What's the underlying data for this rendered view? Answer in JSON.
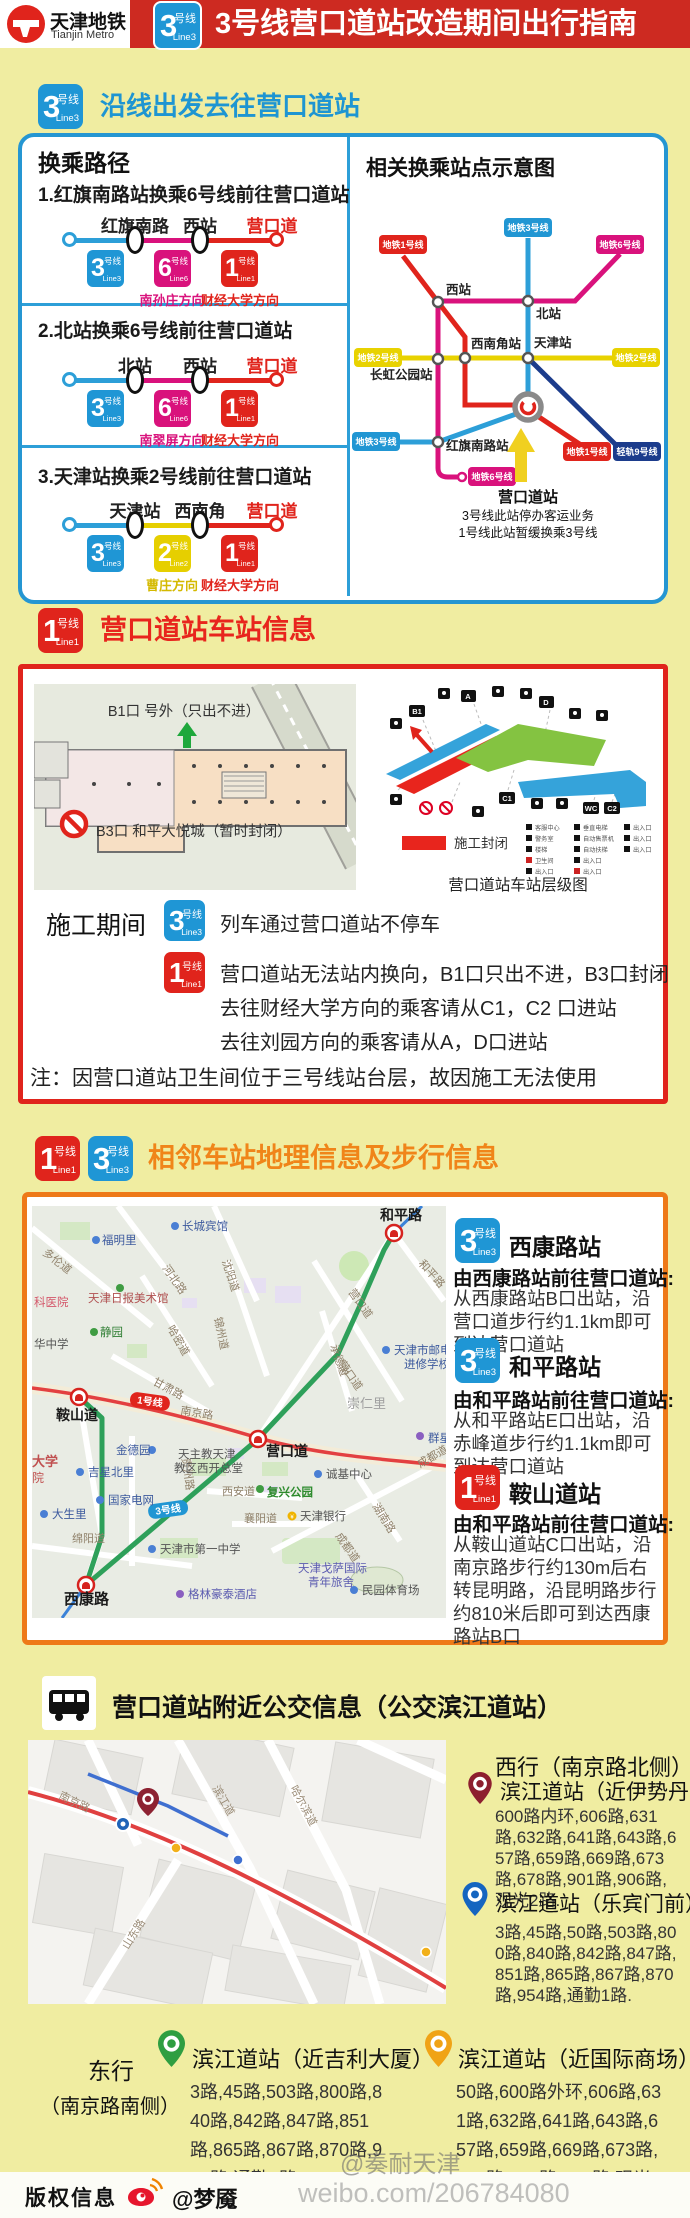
{
  "lines": {
    "l1": {
      "num": "1",
      "cn": "号线",
      "en": "Line1"
    },
    "l2": {
      "num": "2",
      "cn": "号线",
      "en": "Line2"
    },
    "l3": {
      "num": "3",
      "cn": "号线",
      "en": "Line3"
    },
    "l6": {
      "num": "6",
      "cn": "号线",
      "en": "Line6"
    }
  },
  "header": {
    "logo_cn": "天津地铁",
    "logo_en": "Tianjin Metro",
    "title": "3号线营口道站改造期间出行指南"
  },
  "s1": {
    "heading": "沿线出发去往营口道站",
    "left_title": "换乘路径",
    "routes": [
      {
        "no": "1.红旗南路站换乘6号线前往营口道站",
        "st1": "红旗南路",
        "st2": "西站",
        "st3": "营口道",
        "dir1": "南孙庄方向",
        "dir2": "财经大学方向"
      },
      {
        "no": "2.北站换乘6号线前往营口道站",
        "st1": "北站",
        "st2": "西站",
        "st3": "营口道",
        "dir1": "南翠屏方向",
        "dir2": "财经大学方向"
      },
      {
        "no": "3.天津站换乘2号线前往营口道站",
        "st1": "天津站",
        "st2": "西南角",
        "st3": "营口道",
        "dir1": "曹庄方向",
        "dir2": "财经大学方向"
      }
    ],
    "right_title": "相关换乘站点示意图",
    "sch": {
      "b_l1": "地铁1号线",
      "b_l2": "地铁2号线",
      "b_l3": "地铁3号线",
      "b_l6": "地铁6号线",
      "b_l9": "轻轨9号线",
      "xizhan": "西站",
      "beizhan": "北站",
      "xinanjiao": "西南角站",
      "tianjinzhan": "天津站",
      "changhong": "长虹公园站",
      "hongqi": "红旗南路站",
      "callout1": "营口道站",
      "callout2": "3号线此站停办客运业务",
      "callout3": "1号线此站暂缓换乘3号线"
    }
  },
  "s2": {
    "title": "营口道站车站信息",
    "plan": {
      "b1": "B1口 号外（只出不进）",
      "b3": "B3口 和平大悦城（暂时封闭）"
    },
    "level": {
      "legend": "施工封闭",
      "caption": "营口道站车站层级图",
      "e_b1": "B1",
      "e_a": "A",
      "e_d": "D",
      "e_c1": "C1",
      "e_c2": "C2",
      "e_wc": "WC",
      "mini": [
        "客服中心",
        "警务室",
        "楼梯",
        "卫生间",
        "出入口",
        "垂直电梯",
        "自动售票机",
        "自动扶梯",
        "出入口",
        "出入口",
        "出入口",
        "出入口",
        "出入口"
      ]
    },
    "cons": {
      "label": "施工期间",
      "l3_text": "列车通过营口道站不停车",
      "l1_text1": "营口道站无法站内换向，B1口只出不进，B3口封闭",
      "l1_text2": "去往财经大学方向的乘客请从C1，C2 口进站",
      "l1_text3": "去往刘园方向的乘客请从A，D口进站",
      "note": "注：因营口道站卫生间位于三号线站台层，故因施工无法使用"
    }
  },
  "s3": {
    "title": "相邻车站地理信息及步行信息",
    "cards": [
      {
        "name": "西康路站",
        "bold": "由西康路站前往营口道站:",
        "text": "从西康路站B口出站，沿营口道步行约1.1km即可到达营口道站"
      },
      {
        "name": "和平路站",
        "bold": "由和平路站前往营口道站:",
        "text": "从和平路站E口出站，沿赤峰道步行约1.1km即可到达营口道站"
      },
      {
        "name": "鞍山道站",
        "bold": "由和平路站前往营口道站:",
        "text": "从鞍山道站C口出站，沿南京路步行约130m后右转昆明路，沿昆明路步行约810米后即可到达西康路站B口"
      }
    ],
    "map": {
      "duolun": "多伦道",
      "fumingli": "福明里",
      "changcheng": "长城宾馆",
      "hebeilu": "河北路",
      "shenyang": "沈阳道",
      "meishuguan": "天津日报美术馆",
      "jingyuan": "静园",
      "keyi": "科医院",
      "huazhong": "华中学",
      "hami": "哈密道",
      "jinzhou": "锦州道",
      "gansu": "甘肃路",
      "anshandao": "鞍山道",
      "badge_l1": "1号线",
      "nanjinglu": "南京路",
      "chongrenli": "崇仁里",
      "chengde": "承德道",
      "yingkoudao": "营口道",
      "hepinglu": "和平路",
      "youdian1": "天津市邮电通",
      "youdian2": "进修学校",
      "qunxing": "群星",
      "jindeyuan": "金德园",
      "jixing": "吉星北里",
      "dianwang": "国家电网",
      "dashengli": "大生里",
      "mianyang": "绵阳道",
      "tianzhujiao1": "天主教天津",
      "tianzhujiao2": "教区西开总堂",
      "xian": "西安道",
      "fuxing": "复兴公园",
      "xiangyang": "襄阳道",
      "yinhang": "天津银行",
      "chengji": "诚基中心",
      "chengdu": "成都道",
      "hunan": "湖南路",
      "yizhong": "天津市第一中学",
      "gesa1": "天津戈萨国际",
      "gesa2": "青年旅舍",
      "gelin": "格林豪泰酒店",
      "minyuan": "民园体育场",
      "xikanglu": "西康路",
      "badge_l3": "3号线",
      "daxue": "大学",
      "yuan": "院",
      "guizhou": "贵州路"
    }
  },
  "s4": {
    "title": "营口道站附近公交信息（公交滨江道站）",
    "west_heading": "西行（南京路北侧）",
    "west": [
      {
        "name": "滨江道站（近伊势丹）",
        "routes": "600路内环,606路,631路,632路,641路,643路,657路,659路,669路,673路,678路,901路,906路,观光2路."
      },
      {
        "name": "滨江道站（乐宾门前）",
        "routes": "3路,45路,50路,503路,800路,840路,842路,847路,851路,865路,867路,870路,954路,通勤1路."
      }
    ],
    "east_heading1": "东行",
    "east_heading2": "（南京路南侧）",
    "east": [
      {
        "name": "滨江道站（近吉利大厦）",
        "routes": "3路,45路,503路,800路,840路,842路,847路,851路,865路,867路,870路,954路,通勤1路."
      },
      {
        "name": "滨江道站（近国际商场）",
        "routes": "50路,600路外环,606路,631路,632路,641路,643路,657路,659路,669路,673路,678路,901路,906路,观光2路"
      }
    ],
    "map": {
      "nanjinglu": "南京路",
      "haerbin": "哈尔滨道",
      "binjiang": "滨江道",
      "shandong": "山东路"
    }
  },
  "footer": {
    "copyright": "版权信息",
    "handle": "@梦魇",
    "wm1": "@奏耐天津",
    "wm2": "weibo.com/206784080"
  }
}
